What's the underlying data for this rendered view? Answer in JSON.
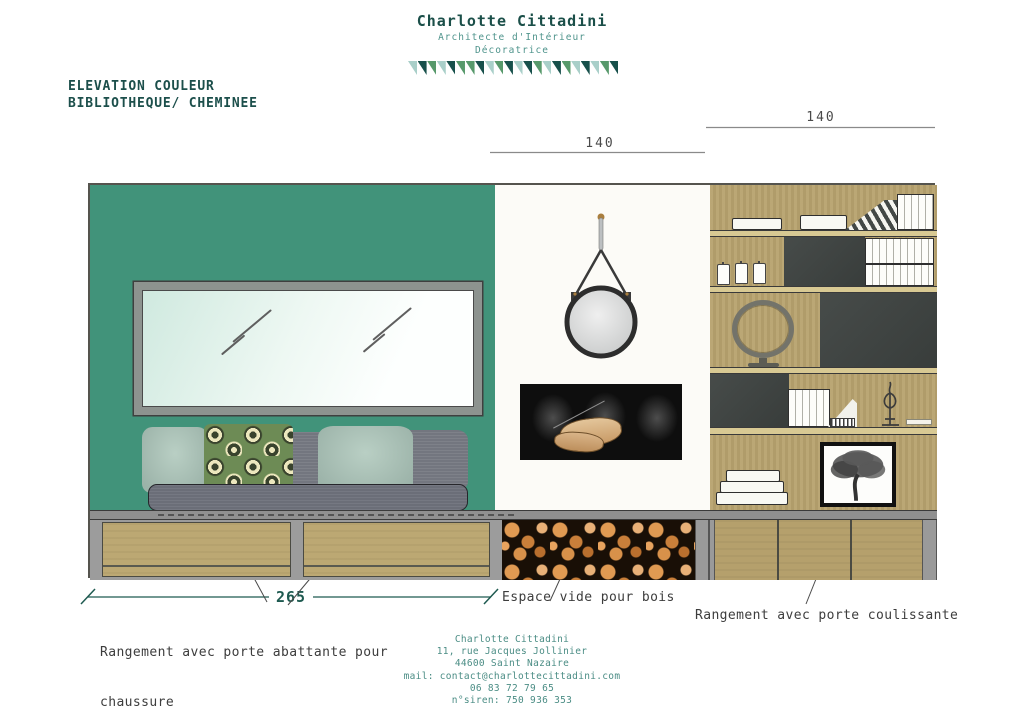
{
  "header": {
    "title": "Charlotte Cittadini",
    "subtitle_line1": "Architecte d'Intérieur",
    "subtitle_line2": "Décoratrice",
    "banner_triangles": [
      "pale",
      "dark",
      "green",
      "pale",
      "dark",
      "green",
      "green",
      "dark",
      "pale",
      "green",
      "dark",
      "pale",
      "dark",
      "green",
      "pale",
      "dark",
      "green",
      "pale",
      "dark",
      "pale",
      "green",
      "dark"
    ]
  },
  "drawing_title": {
    "line1": "ELEVATION COULEUR",
    "line2": "BIBLIOTHEQUE/ CHEMINEE"
  },
  "dimensions": {
    "middle_width": "140",
    "right_width": "140",
    "left_width": "265"
  },
  "annotations": {
    "left_line1": "Rangement avec porte abattante pour",
    "left_line2": "chaussure",
    "middle": "Espace vide pour bois",
    "right": "Rangement avec porte coulissante"
  },
  "footer": {
    "name": "Charlotte Cittadini",
    "address_line1": "11, rue Jacques Jollinier",
    "address_line2": "44600 Saint Nazaire",
    "email": "mail: contact@charlottecittadini.com",
    "phone": "06 83 72 79 65",
    "siren": "n°siren: 750 936 353"
  },
  "colors": {
    "brand_teal_dark": "#1b4f49",
    "brand_teal_mid": "#4f948c",
    "banner_pale": "#a9cfc9",
    "banner_dark": "#17504b",
    "banner_green": "#57996b",
    "wall_green": "#41937a",
    "wood": "#b7a26e",
    "dark_panel": "#3d4240",
    "dimension_accent": "#1e5a50"
  }
}
